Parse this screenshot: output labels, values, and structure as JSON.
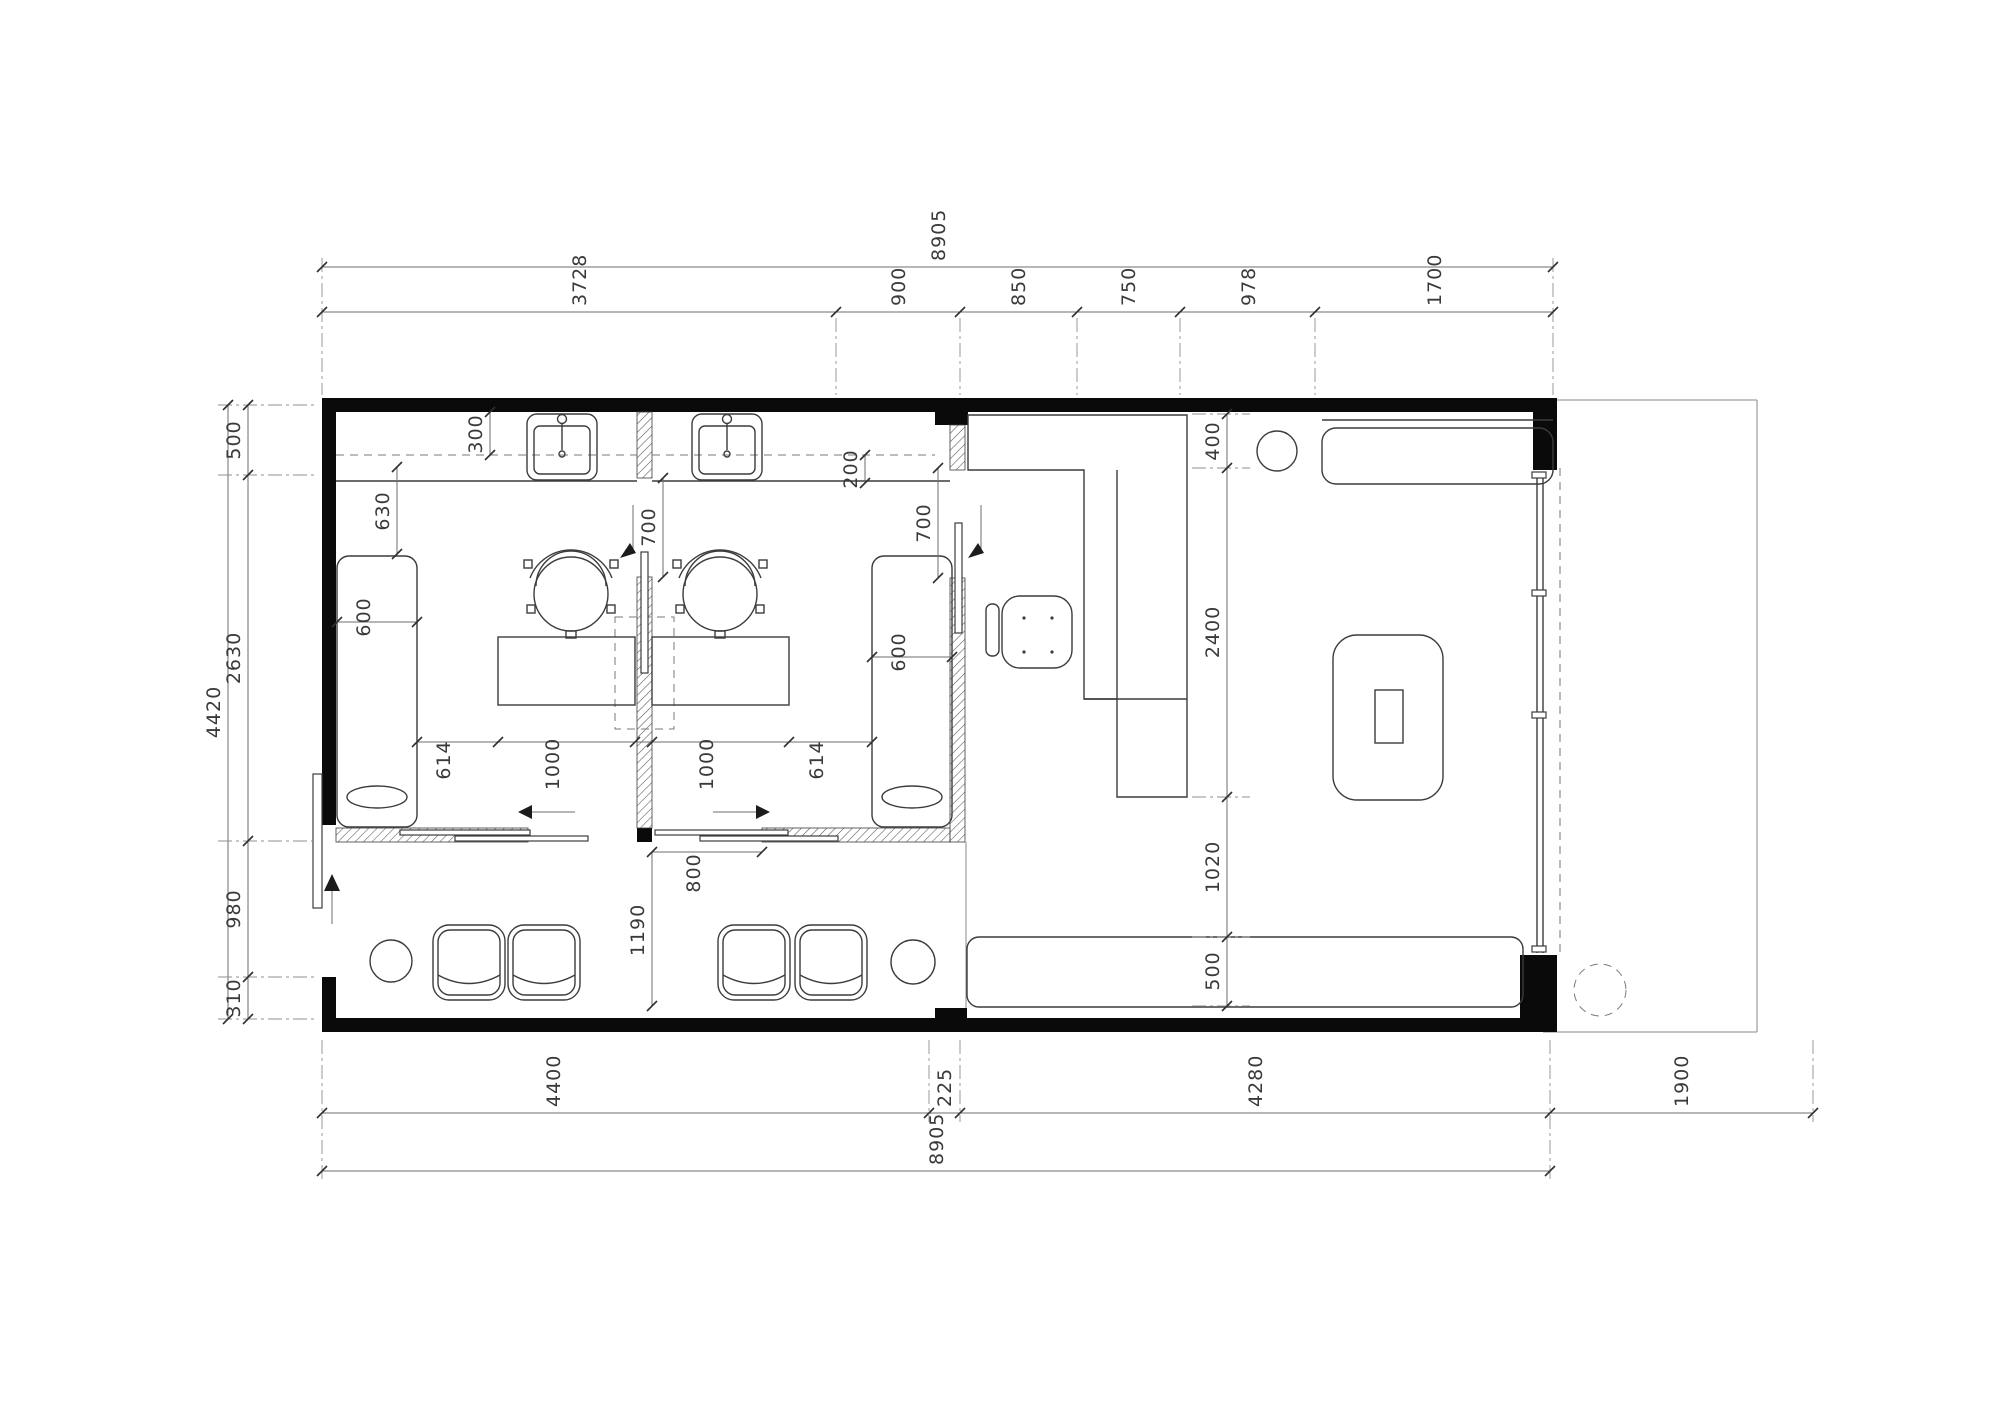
{
  "drawing": {
    "type": "floor-plan",
    "colors": {
      "wall": "#0a0a0a",
      "ink": "#3c3c3c",
      "dim_line": "#6e6e6e"
    }
  },
  "dimensions": {
    "top_overall": "8905",
    "top_segments": [
      "3728",
      "900",
      "850",
      "750",
      "978",
      "1700"
    ],
    "bottom_segments": [
      "4400",
      "225",
      "4280",
      "1900"
    ],
    "bottom_overall": "8905",
    "left_overall": "4420",
    "left_segments": [
      "500",
      "2630",
      "980",
      "310"
    ],
    "right_segments": [
      "400",
      "2400",
      "1020",
      "500"
    ],
    "interior": {
      "mirror_depth": "300",
      "counter_overhang": "200",
      "bed_clearance": "630",
      "bed_width_left": "600",
      "bed_width_right": "600",
      "partition_door": "700",
      "backroom_door": "700",
      "desk_chain": [
        "614",
        "1000",
        "1000",
        "614"
      ],
      "sliding_door": "800",
      "corridor": "1190"
    }
  }
}
